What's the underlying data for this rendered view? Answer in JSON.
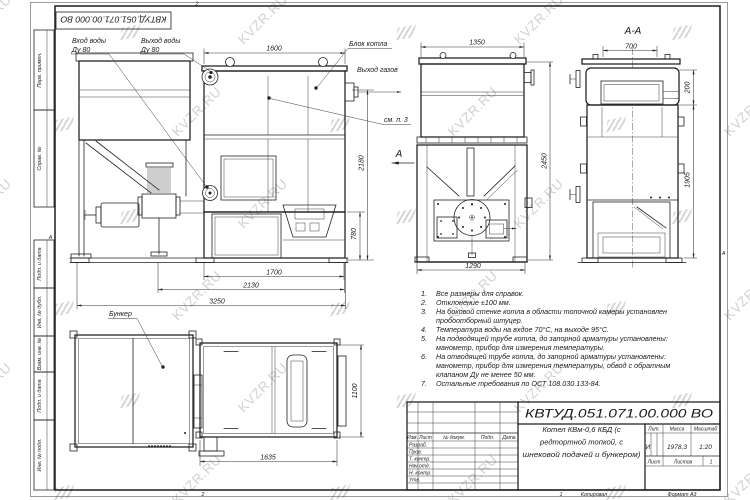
{
  "watermark": {
    "text": "KVZR.RU"
  },
  "stamp_top": {
    "doc_number": "КВТУД.051.071.00.000 ВО"
  },
  "frame": {
    "zone_top": "2",
    "zone_bottom_left": "2",
    "zone_bottom_right": "1",
    "zone_letter_left": "А",
    "zone_letter_right": "А",
    "copied": "Копировал",
    "format": "Формат А3",
    "margin_labels": [
      "Перв. примен.",
      "Справ. №",
      "Подп. и дата",
      "Инв. № дубл.",
      "Взам. инв. №",
      "Подп. и дата",
      "Инв. № подл."
    ]
  },
  "labels": {
    "water_in_line1": "Вход воды",
    "water_in_line2": "Ду 80",
    "water_out_line1": "Выход воды",
    "water_out_line2": "Ду 80",
    "boiler_block": "Блок котла",
    "gas_out": "Выход газов",
    "see_note": "см. п. 3",
    "view_letter": "А",
    "section_title": "А-А",
    "bunker": "Бункер"
  },
  "dims": {
    "main_width": "1600",
    "main_height": "2180",
    "firebox_height": "780",
    "feeder_len": "1700",
    "total_len_mid": "2130",
    "total_len": "3250",
    "front_width": "1350",
    "front_height": "2450",
    "front_base": "1290",
    "sec_top_width": "700",
    "sec_top_height": "200",
    "sec_body_height": "1905",
    "plan_len": "1635",
    "plan_depth": "1100"
  },
  "notes": [
    {
      "num": "1.",
      "text": "Все размеры для справок."
    },
    {
      "num": "2.",
      "text": "Отклонение ±100 мм."
    },
    {
      "num": "3.",
      "text": "На боковой стенке котла в области топочной камеры установлен"
    },
    {
      "num": "",
      "text": "пробоотборный штуцер."
    },
    {
      "num": "4.",
      "text": "Температура воды на вхдое 70°С, на выходе 95°С."
    },
    {
      "num": "5.",
      "text": "На подводящей трубе котла, до запорной арматуры установлены:"
    },
    {
      "num": "",
      "text": "манометр, прибор для измерения температуры."
    },
    {
      "num": "6.",
      "text": "На отводящей трубе котла, до запорной арматуры установлены:"
    },
    {
      "num": "",
      "text": "манометр, прибор для измерения температуры, обвод с обратным"
    },
    {
      "num": "",
      "text": "клапаном Ду не менее 50 мм."
    },
    {
      "num": "7.",
      "text": "Остальные требования по ОСТ 108.030.133-84."
    }
  ],
  "title_block": {
    "doc_number": "КВТУД.051.071.00.000 ВО",
    "name_line1": "Котел КВм-0,6 КБД (с",
    "name_line2": "редтортной топкой, с",
    "name_line3": "шнековой подачей и бункером)",
    "col_izm": "Изм.",
    "col_list": "Лист",
    "col_doc": "№ докум.",
    "col_podp": "Подп.",
    "col_data": "Дата",
    "row_razrab": "Разраб.",
    "row_prov": "Пров.",
    "row_tkontr": "Т. контр.",
    "row_nachotd": "Нач.отд.",
    "row_nkontr": "Н. контр.",
    "row_utv": "Утв.",
    "lit_label": "Лит.",
    "lit_value": "И",
    "mass_label": "Масса",
    "mass_value": "1978,3",
    "scale_label": "Масштаб",
    "scale_value": "1:20",
    "sheet_label": "Лист",
    "sheets_label": "Листов",
    "sheets_value": "1"
  }
}
